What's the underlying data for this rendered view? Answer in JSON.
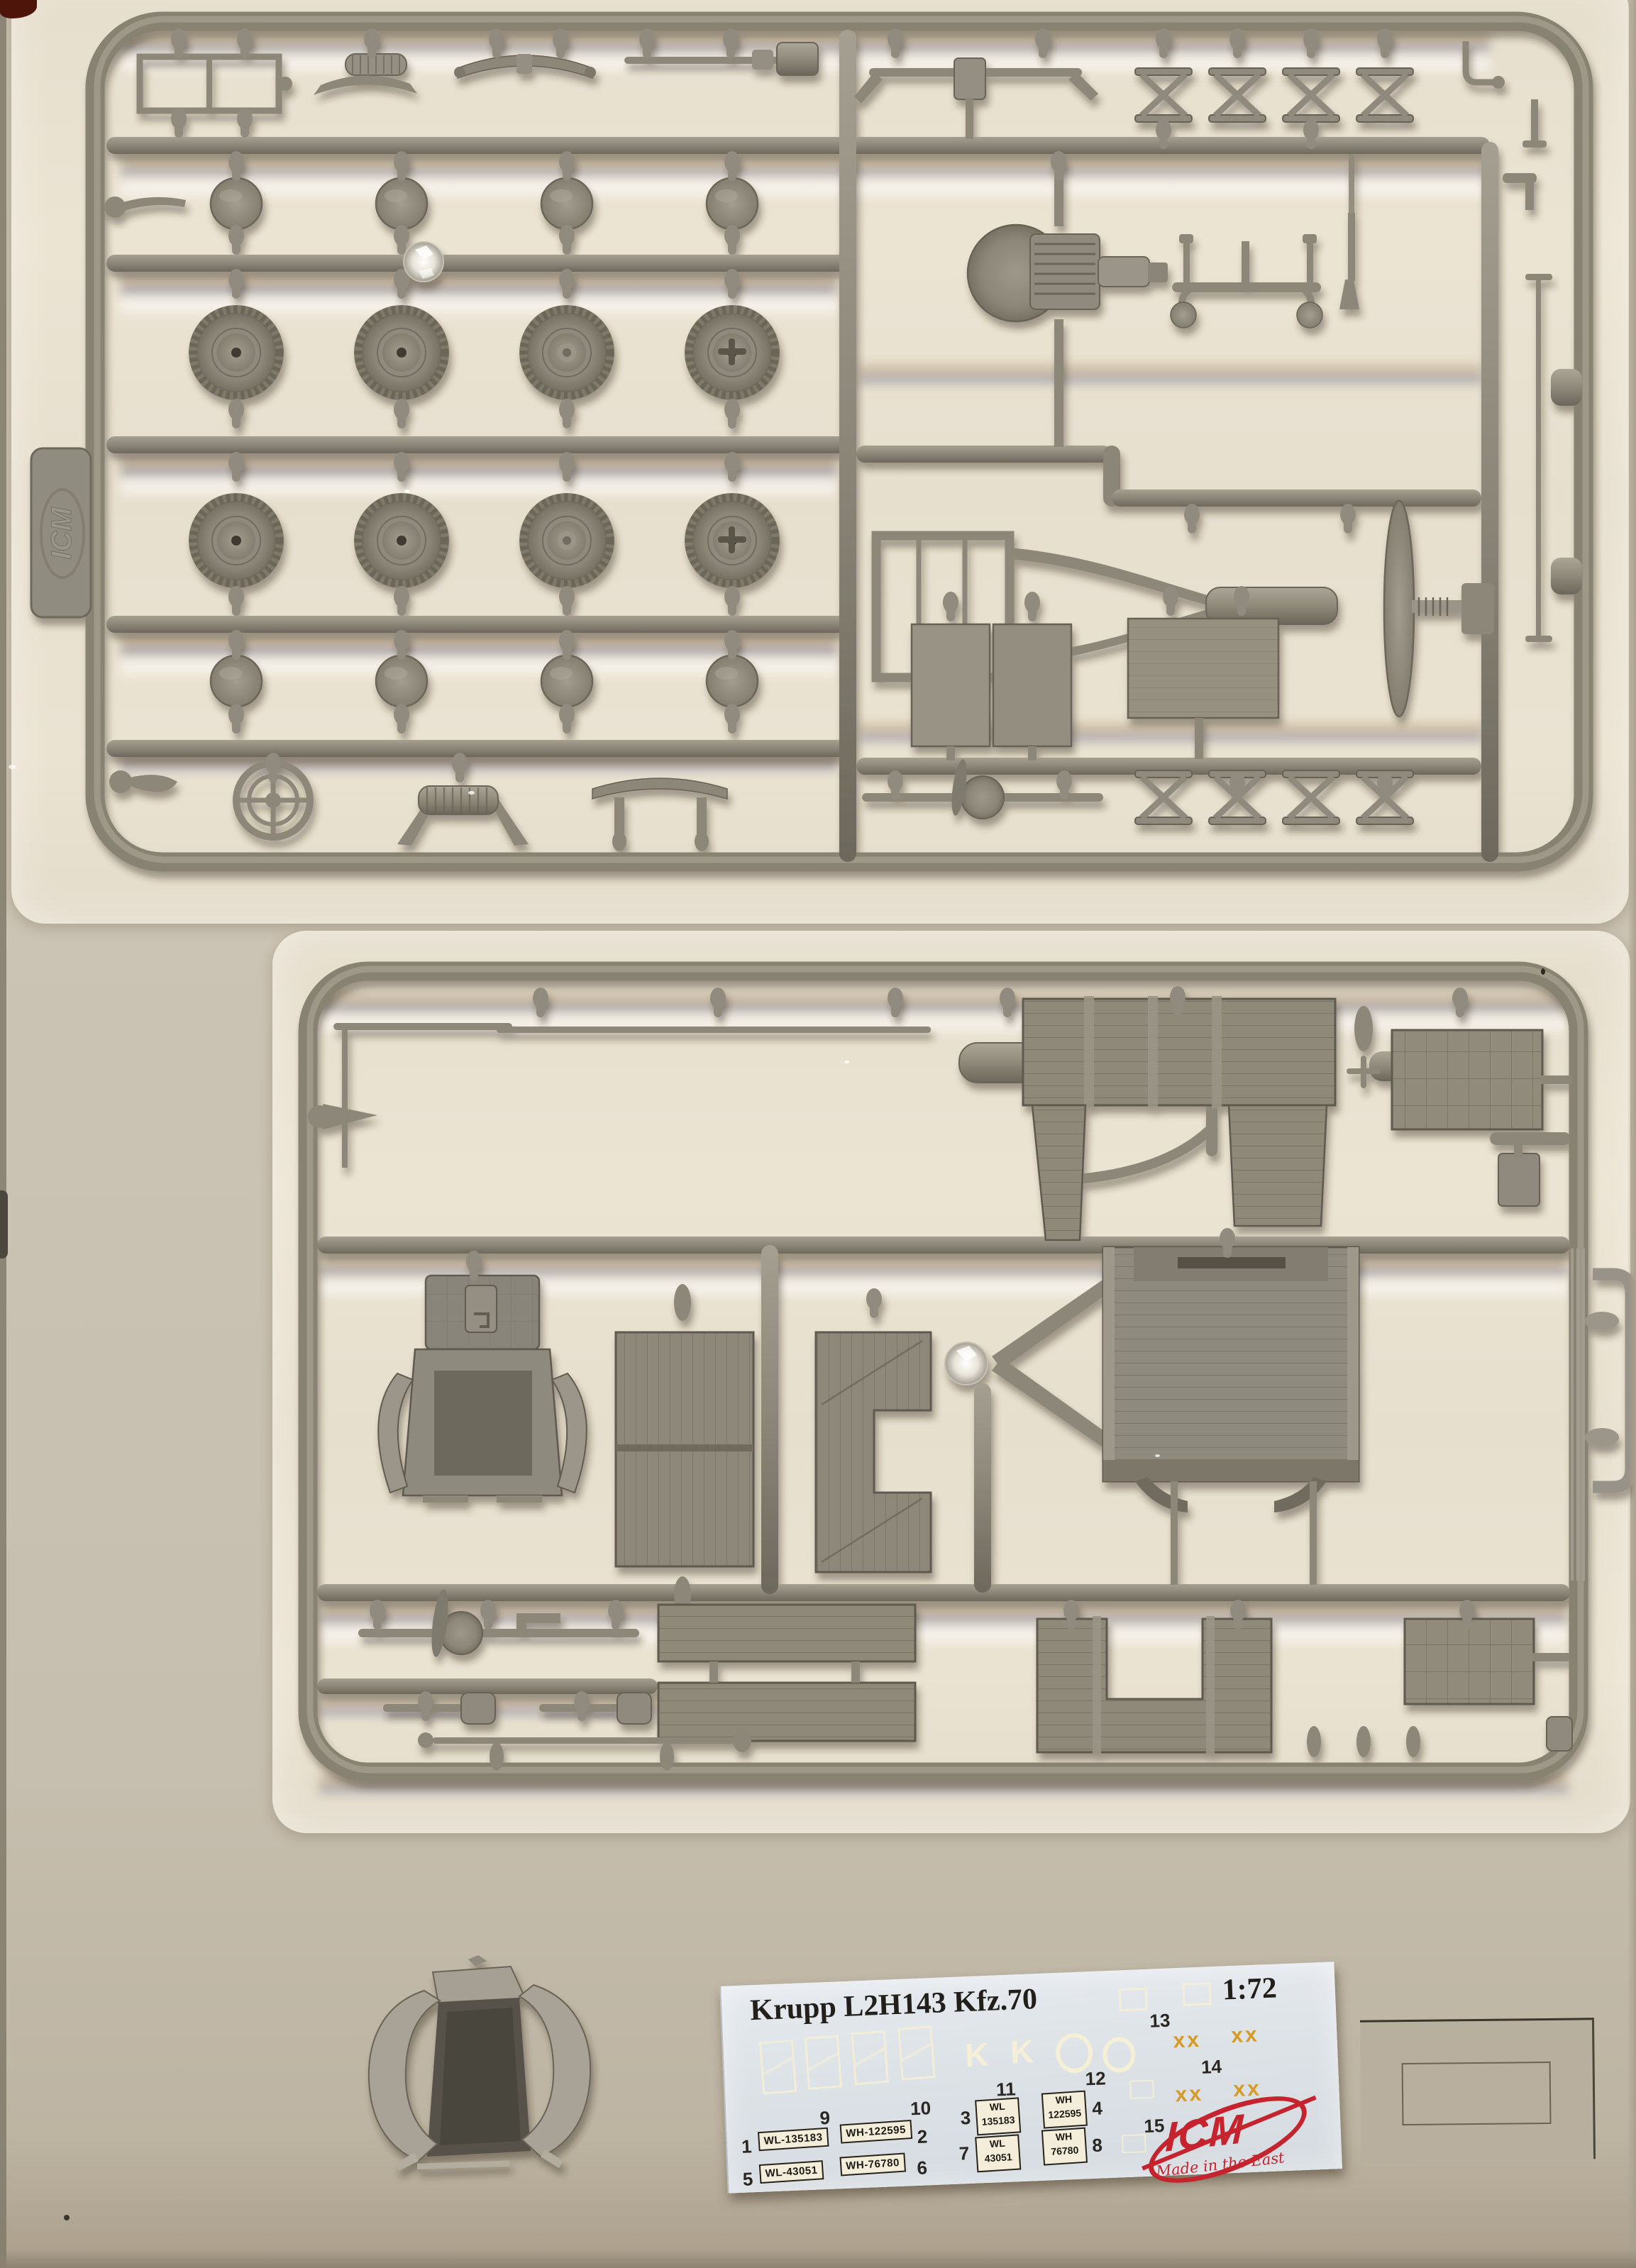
{
  "product": {
    "kit_name": "Krupp L2H143 Kfz.70",
    "kit_scale": "1:72"
  },
  "sprues": {
    "tab_logo": "ICM"
  },
  "decal_sheet": {
    "title": "Krupp L2H143 Kfz.70",
    "scale": "1:72",
    "numbers": {
      "n1": "1",
      "n2": "2",
      "n3": "3",
      "n4": "4",
      "n5": "5",
      "n6": "6",
      "n7": "7",
      "n8": "8",
      "n9": "9",
      "n10": "10",
      "n11": "11",
      "n12": "12",
      "n13": "13",
      "n14": "14",
      "n15": "15"
    },
    "plates_long": [
      {
        "text": "WL-135183"
      },
      {
        "text": "WH-122595"
      },
      {
        "text": "WL-43051"
      },
      {
        "text": "WH-76780"
      }
    ],
    "plates_square": [
      {
        "top": "WL",
        "bottom": "135183"
      },
      {
        "top": "WH",
        "bottom": "122595"
      },
      {
        "top": "WL",
        "bottom": "43051"
      },
      {
        "top": "WH",
        "bottom": "76780"
      }
    ],
    "letters": [
      "K",
      "K"
    ],
    "cross_marks": "xx",
    "brand": {
      "name": "ICM",
      "tagline": "Made in the East"
    }
  },
  "colors": {
    "background": "#c9c1b1",
    "bag": "#e9e1d0",
    "plastic": "#8c8779",
    "plastic_dark": "#615c51",
    "decal_paper": "#dde2e7",
    "plate_cream": "#f4edd9",
    "brand_red": "#c5242e",
    "decal_orange": "#d79a26",
    "fringe_blue": "#1d3f7e",
    "fringe_brown": "#8a5a28"
  }
}
